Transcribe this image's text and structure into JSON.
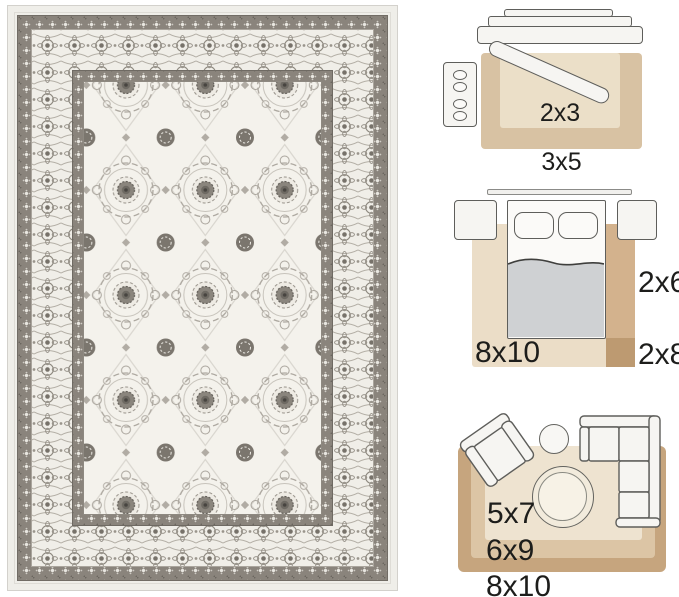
{
  "page": {
    "background": "#ffffff",
    "description": "Area rug product photo with room size-guide diagrams",
    "text_color": "#1d1d1b"
  },
  "rug_photo": {
    "style": "traditional oriental medallion rug, ivory and gray",
    "colors": {
      "binding": "#efeee9",
      "border_dark": "#8a847c",
      "border_ivory": "#f0eee8",
      "field": "#f4f2ec",
      "motif_dark": "#7b766e",
      "motif_light": "#aca79f"
    }
  },
  "diagrams": [
    {
      "id": "entryway",
      "furniture": [
        "console-table",
        "bench",
        "dresser"
      ],
      "rugs": [
        {
          "size": "2x3",
          "color": "#ebdfc8"
        },
        {
          "size": "3x5",
          "color": "#d8c2a3"
        }
      ]
    },
    {
      "id": "bedroom",
      "furniture": [
        "wall-line",
        "nightstand-left",
        "nightstand-right",
        "bed"
      ],
      "rugs": [
        {
          "size": "8x10",
          "color": "#ebddc7"
        },
        {
          "size": "2x6",
          "color": "#d3b28d"
        },
        {
          "size": "2x8",
          "color": "#bd9a71"
        }
      ]
    },
    {
      "id": "living-room",
      "furniture": [
        "armchair",
        "side-table",
        "sectional-sofa",
        "round-coffee-table"
      ],
      "rugs": [
        {
          "size": "5x7",
          "color": "#eee3d0"
        },
        {
          "size": "6x9",
          "color": "#dcc5a5"
        },
        {
          "size": "8x10",
          "color": "#c6a57e"
        }
      ]
    }
  ]
}
